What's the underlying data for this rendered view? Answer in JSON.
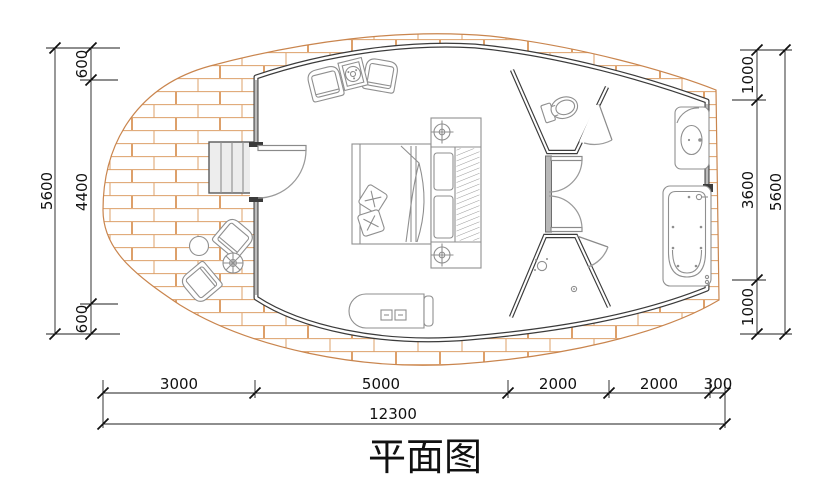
{
  "title": {
    "text": "平面图"
  },
  "dims": {
    "left": {
      "overall": "5600",
      "top": "600",
      "mid": "4400",
      "bottom": "600"
    },
    "right": {
      "overall": "5600",
      "top": "1000",
      "mid": "3600",
      "bottom": "1000"
    },
    "bottom": {
      "overall": "12300",
      "s1": "3000",
      "s2": "5000",
      "s3": "2000",
      "s4": "2000",
      "s5": "300"
    }
  },
  "colors": {
    "wall": "#3b3b3b",
    "deck_brick": "#dda06a",
    "deck_edge": "#c9854e",
    "furniture_line": "#8f8f8f",
    "partition_fill": "#b8b8b8",
    "dimension": "#111111",
    "background": "#ffffff"
  }
}
